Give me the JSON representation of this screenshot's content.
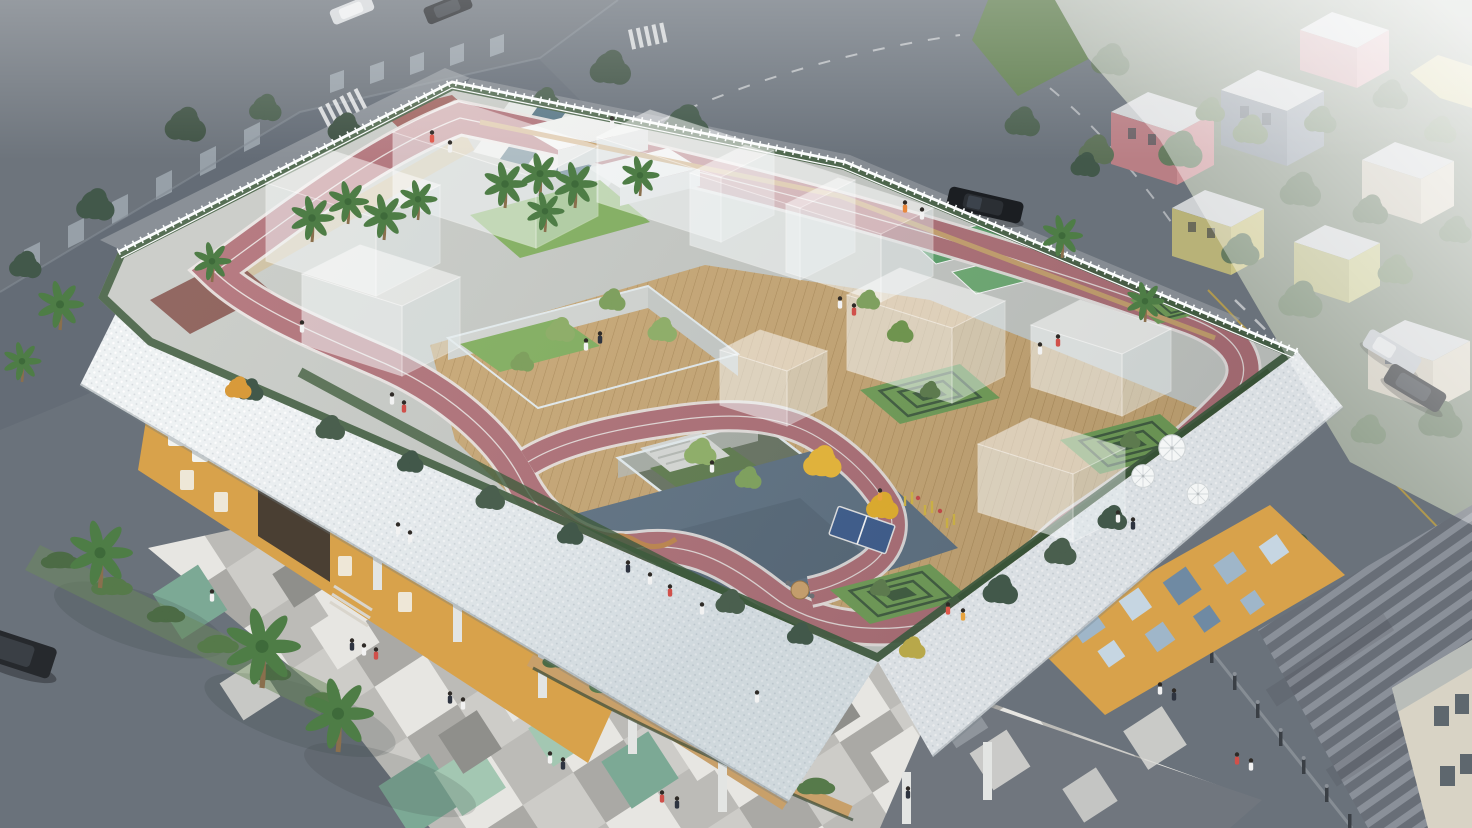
{
  "scene": {
    "type": "architectural-aerial-rendering",
    "description": "Aerial rendering of a school building whose roof is a playground: a winding pink running track with white lane lines, wooden decks, sunken tree courtyards, translucent glass pavilions, a white-and-slate checkerboard plaza, a blue sports court with a table-tennis table, terraced hedge mounds and a white picket fence, all above a yellow ground floor wrapped in a white perforated band; around it are streets with parked cars, checker-paved plazas with palm trees and a hazy residential district."
  },
  "palette": {
    "asphalt": "#6a727b",
    "asphaltDark": "#5d656f",
    "sidewalk": "#a9aeb2",
    "campusBuilding": "#6d747c",
    "campusWindow": "#9fa8b0",
    "grassVerge": "#5f7d4e",
    "treeDark": "#42584a",
    "treeGreen": "#5d7a4e",
    "treeLight": "#8fae6a",
    "palmGreen": "#4e7d46",
    "palmDark": "#3e6a3a",
    "residentialBase": "#7c8878",
    "housePink": "#c98f94",
    "housePinkLight": "#d3a3a8",
    "houseYellow": "#c9c386",
    "houseCream": "#d6d0c1",
    "houseGray": "#8f99a4",
    "houseRoof": "#ced1d3",
    "fog": "#ffffff",
    "plazaBase": "#bcbbb7",
    "plazaLight": "#cdccc8",
    "plazaWhite": "#e7e6e2",
    "plazaMid": "#aaa9a5",
    "plazaDark": "#8f8f8b",
    "plazaGreen": "#7ca995",
    "plazaMint": "#a3c7b2",
    "darkPlaza": "#70767e",
    "stripeLight": "#8a9099",
    "stripeBase": "#686e77",
    "lattice": "#e9edef",
    "latticeShade": "#c7ced3",
    "yellowWall": "#d8a24b",
    "yellowWallShade": "#c08a3e",
    "windowWhite": "#f2f3f0",
    "portalDark": "#4a3f33",
    "mosaicBlue": "#9fb6c9",
    "mosaicBlueLight": "#c6d6e2",
    "mosaicBlueDark": "#6f8aa3",
    "woodDeck": "#c8a671",
    "woodLine": "#ad8a55",
    "woodWalk": "#c8a06a",
    "concrete": "#c6c9c4",
    "whiteBlock": "#f3f4f2",
    "track": "#ae6d74",
    "trackDark": "#8f4a49",
    "lane": "#ece5e3",
    "checkerSlate": "#4e6f7f",
    "checkerWhite": "#e6e9e6",
    "lawn": "#7fae5a",
    "grass": "#6f9d53",
    "hedge": "#3d5a3b",
    "hedgeLight": "#567a4a",
    "courtGreen": "#58a066",
    "courtGreenLight": "#6cab70",
    "courtBlue": "#5c6f80",
    "courtBlueDark": "#4f6170",
    "tableBlue": "#3a5a8c",
    "benchWood": "#c08448",
    "tableTan": "#cfa36a",
    "equipYellow": "#d8b93f",
    "ginkgo": "#e0b23c",
    "fence": "#fbfdfd",
    "glassFace": "#e8f0f2",
    "carBlack": "#1b1e22",
    "carSilver": "#b9bec4",
    "carWhite": "#d4d7da",
    "carDark": "#24272b",
    "cornerBuilding": "#d8d3c5",
    "umbrella": "#f4f6f6"
  },
  "features": {
    "rooftop": [
      "winding running track",
      "checkerboard plaza",
      "palm-tree lawn",
      "sunken courtyard",
      "central lightwell",
      "glass pavilions",
      "blue sports court",
      "table tennis table",
      "outdoor fitness equipment",
      "cafe tables",
      "serpentine benches",
      "terraced hedge mounds",
      "green practice courts",
      "perimeter picket fence",
      "perimeter hedge",
      "white sun umbrellas",
      "wood deck"
    ],
    "building": [
      "white perforated facade band",
      "yellow ground-floor facade",
      "white framed windows",
      "entrance portal",
      "wood walkway",
      "planter balcony",
      "pilotis columns",
      "blue diamond mosaic wall"
    ],
    "surroundings": [
      "campus building",
      "asphalt streets",
      "zebra crossing",
      "street trees",
      "residential houses in fog",
      "parked cars",
      "checker-paved plaza",
      "palm trees",
      "shrub verge",
      "bollard row",
      "striped walkway",
      "corner building",
      "lawn patch"
    ]
  }
}
